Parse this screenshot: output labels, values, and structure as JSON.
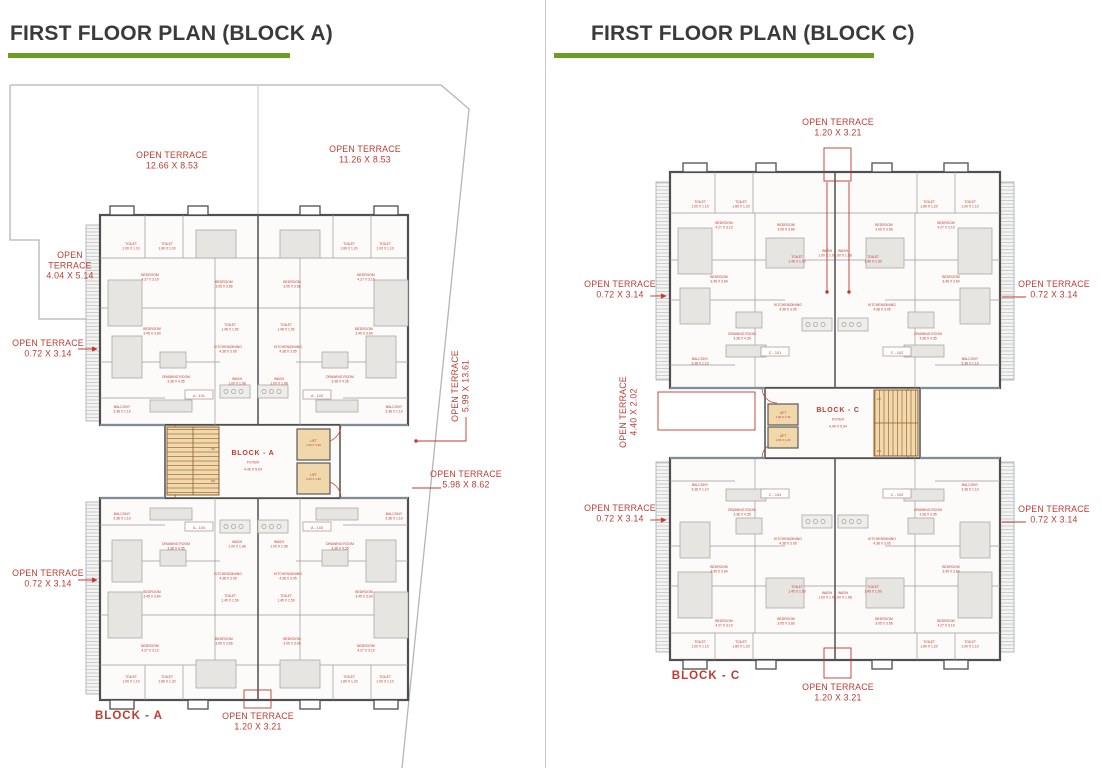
{
  "panels": [
    {
      "title": "FIRST FLOOR PLAN (BLOCK A)"
    },
    {
      "title": "FIRST FLOOR PLAN (BLOCK C)"
    }
  ],
  "colors": {
    "annotation_red": "#bf3b32",
    "heading_green": "#6d9d22",
    "title_gray": "#3a3a3a"
  },
  "left_plan": {
    "core": {
      "x": 253,
      "y": 455,
      "name": "BLOCK - A",
      "sub": "FOYER",
      "dim": "4.40 X 5.04"
    },
    "lift": {
      "label": "LIFT",
      "dim": "1.00 X 1.30",
      "positions": [
        [
          313.5,
          442
        ],
        [
          313.5,
          476
        ]
      ]
    },
    "stair_labels": [
      {
        "t": "UP",
        "x": 213,
        "y": 450
      },
      {
        "t": "DN",
        "x": 213,
        "y": 482
      }
    ],
    "units": [
      {
        "label": "A - 101",
        "x": 199,
        "y": 395
      },
      {
        "label": "A - 102",
        "x": 317,
        "y": 395
      },
      {
        "label": "A - 104",
        "x": 199,
        "y": 527
      },
      {
        "label": "A - 103",
        "x": 317,
        "y": 527
      }
    ],
    "boxes": [
      {
        "x": 244,
        "y": 690,
        "w": 27,
        "h": 18
      }
    ],
    "annotations": [
      {
        "lines": [
          "OPEN TERRACE",
          "12.66 X 8.53"
        ],
        "x": 172,
        "y": 158
      },
      {
        "lines": [
          "OPEN TERRACE",
          "11.26 X 8.53"
        ],
        "x": 365,
        "y": 152
      },
      {
        "lines": [
          "OPEN",
          "TERRACE",
          "4.04 X 5.14"
        ],
        "x": 70,
        "y": 258
      },
      {
        "lines": [
          "OPEN TERRACE",
          "0.72 X 3.14"
        ],
        "x": 48,
        "y": 346,
        "leaders": [
          {
            "pts": [
              [
                78,
                349
              ],
              [
                97,
                349
              ]
            ],
            "arrow": true
          }
        ]
      },
      {
        "lines": [
          "OPEN TERRACE",
          "0.72 X 3.14"
        ],
        "x": 48,
        "y": 576,
        "leaders": [
          {
            "pts": [
              [
                78,
                580
              ],
              [
                97,
                580
              ]
            ],
            "arrow": true
          }
        ]
      },
      {
        "lines": [
          "OPEN TERRACE",
          "5.99 X 13.61"
        ],
        "x": 458,
        "y": 386,
        "rot": -90,
        "leaders": [
          {
            "pts": [
              [
                466,
                417
              ],
              [
                466,
                441
              ],
              [
                416,
                441
              ]
            ],
            "dot": true
          }
        ]
      },
      {
        "lines": [
          "OPEN TERRACE",
          "5.98 X 8.62"
        ],
        "x": 466,
        "y": 477,
        "leaders": [
          {
            "pts": [
              [
                441,
                488
              ],
              [
                412,
                488
              ]
            ]
          }
        ]
      },
      {
        "lines": [
          "OPEN TERRACE",
          "1.20 X 3.21"
        ],
        "x": 258,
        "y": 719
      },
      {
        "lines": [
          "BLOCK  - A"
        ],
        "x": 129,
        "y": 719,
        "size": 11.5,
        "bold": true
      }
    ],
    "rooms": [
      {
        "t": "TOILET",
        "d": "1.00 X 1.10",
        "x": 131,
        "y": 245
      },
      {
        "t": "TOILET",
        "d": "1.89 X 1.20",
        "x": 167,
        "y": 245
      },
      {
        "t": "BEDROOM",
        "d": "4.27 X 3.19",
        "x": 150,
        "y": 276
      },
      {
        "t": "BEDROOM",
        "d": "3.05 X 3.66",
        "x": 224,
        "y": 283
      },
      {
        "t": "BEDROOM",
        "d": "3.45 X 3.64",
        "x": 152,
        "y": 330
      },
      {
        "t": "TOILET",
        "d": "1.45 X 1.50",
        "x": 230,
        "y": 326
      },
      {
        "t": "KITCHEN/DINING",
        "d": "4.38 X 3.05",
        "x": 228,
        "y": 348
      },
      {
        "t": "DRAWING ROOM",
        "d": "3.38 X 4.35",
        "x": 176,
        "y": 378
      },
      {
        "t": "WASH",
        "d": "1.00 X 1.98",
        "x": 237,
        "y": 380
      },
      {
        "t": "BALCONY",
        "d": "3.38 X 1.10",
        "x": 122,
        "y": 408
      },
      {
        "t": "TOILET",
        "d": "1.00 X 1.10",
        "x": 385,
        "y": 245
      },
      {
        "t": "TOILET",
        "d": "1.89 X 1.20",
        "x": 349,
        "y": 245
      },
      {
        "t": "BEDROOM",
        "d": "4.27 X 3.19",
        "x": 366,
        "y": 276
      },
      {
        "t": "BEDROOM",
        "d": "3.05 X 3.66",
        "x": 292,
        "y": 283
      },
      {
        "t": "BEDROOM",
        "d": "3.45 X 3.64",
        "x": 364,
        "y": 330
      },
      {
        "t": "TOILET",
        "d": "1.45 X 1.50",
        "x": 286,
        "y": 326
      },
      {
        "t": "KITCHEN/DINING",
        "d": "4.38 X 3.05",
        "x": 288,
        "y": 348
      },
      {
        "t": "DRAWING ROOM",
        "d": "3.38 X 4.35",
        "x": 340,
        "y": 378
      },
      {
        "t": "WASH",
        "d": "1.00 X 1.98",
        "x": 279,
        "y": 380
      },
      {
        "t": "BALCONY",
        "d": "3.38 X 1.10",
        "x": 394,
        "y": 408
      },
      {
        "t": "TOILET",
        "d": "1.00 X 1.10",
        "x": 131,
        "y": 678
      },
      {
        "t": "TOILET",
        "d": "1.89 X 1.20",
        "x": 167,
        "y": 678
      },
      {
        "t": "BEDROOM",
        "d": "4.27 X 3.19",
        "x": 150,
        "y": 647
      },
      {
        "t": "BEDROOM",
        "d": "3.05 X 3.66",
        "x": 224,
        "y": 640
      },
      {
        "t": "BEDROOM",
        "d": "3.45 X 3.64",
        "x": 152,
        "y": 593
      },
      {
        "t": "TOILET",
        "d": "1.45 X 1.50",
        "x": 230,
        "y": 597
      },
      {
        "t": "KITCHEN/DINING",
        "d": "4.38 X 3.05",
        "x": 228,
        "y": 575
      },
      {
        "t": "DRAWING ROOM",
        "d": "3.38 X 4.35",
        "x": 176,
        "y": 545
      },
      {
        "t": "WASH",
        "d": "1.00 X 1.98",
        "x": 237,
        "y": 543
      },
      {
        "t": "BALCONY",
        "d": "3.38 X 1.10",
        "x": 122,
        "y": 515
      },
      {
        "t": "TOILET",
        "d": "1.00 X 1.10",
        "x": 385,
        "y": 678
      },
      {
        "t": "TOILET",
        "d": "1.89 X 1.20",
        "x": 349,
        "y": 678
      },
      {
        "t": "BEDROOM",
        "d": "4.27 X 3.19",
        "x": 366,
        "y": 647
      },
      {
        "t": "BEDROOM",
        "d": "3.05 X 3.66",
        "x": 292,
        "y": 640
      },
      {
        "t": "BEDROOM",
        "d": "3.45 X 3.64",
        "x": 364,
        "y": 593
      },
      {
        "t": "TOILET",
        "d": "1.45 X 1.50",
        "x": 286,
        "y": 597
      },
      {
        "t": "KITCHEN/DINING",
        "d": "4.38 X 3.05",
        "x": 288,
        "y": 575
      },
      {
        "t": "DRAWING ROOM",
        "d": "3.38 X 4.35",
        "x": 340,
        "y": 545
      },
      {
        "t": "WASH",
        "d": "1.00 X 1.98",
        "x": 279,
        "y": 543
      },
      {
        "t": "BALCONY",
        "d": "3.38 X 1.10",
        "x": 394,
        "y": 515
      }
    ]
  },
  "right_plan": {
    "core": {
      "x": 838,
      "y": 412,
      "name": "BLOCK - C",
      "sub": "FOYER",
      "dim": "4.40 X 5.04"
    },
    "lift": {
      "label": "LIFT",
      "dim": "1.00 X 1.30",
      "positions": [
        [
          783,
          414
        ],
        [
          783,
          437
        ]
      ]
    },
    "stair_labels": [
      {
        "t": "UP",
        "x": 879,
        "y": 400
      },
      {
        "t": "DN",
        "x": 879,
        "y": 452
      }
    ],
    "units": [
      {
        "label": "C - 101",
        "x": 775,
        "y": 352
      },
      {
        "label": "C - 102",
        "x": 897,
        "y": 352
      },
      {
        "label": "C - 104",
        "x": 775,
        "y": 494
      },
      {
        "label": "C - 103",
        "x": 897,
        "y": 494
      }
    ],
    "boxes": [
      {
        "x": 824,
        "y": 148,
        "w": 27,
        "h": 33
      },
      {
        "x": 824,
        "y": 648,
        "w": 27,
        "h": 30
      },
      {
        "x": 658,
        "y": 392,
        "w": 97,
        "h": 38
      }
    ],
    "annotations": [
      {
        "lines": [
          "OPEN TERRACE",
          "1.20 X 3.21"
        ],
        "x": 838,
        "y": 125,
        "leaders": [
          {
            "pts": [
              [
                827,
                182
              ],
              [
                827,
                292
              ]
            ],
            "dot": true
          },
          {
            "pts": [
              [
                849,
                182
              ],
              [
                849,
                292
              ]
            ],
            "dot": true
          }
        ]
      },
      {
        "lines": [
          "OPEN TERRACE",
          "0.72 X 3.14"
        ],
        "x": 620,
        "y": 287,
        "leaders": [
          {
            "pts": [
              [
                650,
                296
              ],
              [
                666,
                296
              ]
            ],
            "arrow": true
          }
        ]
      },
      {
        "lines": [
          "OPEN TERRACE",
          "4.40 X 2.02"
        ],
        "x": 626,
        "y": 412,
        "rot": -90
      },
      {
        "lines": [
          "OPEN TERRACE",
          "0.72 X 3.14"
        ],
        "x": 620,
        "y": 511,
        "leaders": [
          {
            "pts": [
              [
                650,
                520
              ],
              [
                666,
                520
              ]
            ],
            "arrow": true
          }
        ]
      },
      {
        "lines": [
          "OPEN TERRACE",
          "0.72 X 3.14"
        ],
        "x": 1054,
        "y": 287,
        "leaders": [
          {
            "pts": [
              [
                1026,
                297
              ],
              [
                1002,
                297
              ]
            ]
          }
        ]
      },
      {
        "lines": [
          "OPEN TERRACE",
          "0.72 X 3.14"
        ],
        "x": 1054,
        "y": 512,
        "leaders": [
          {
            "pts": [
              [
                1026,
                522
              ],
              [
                1002,
                522
              ]
            ]
          }
        ]
      },
      {
        "lines": [
          "OPEN TERRACE",
          "1.20 X 3.21"
        ],
        "x": 838,
        "y": 690
      },
      {
        "lines": [
          "BLOCK  - C"
        ],
        "x": 706,
        "y": 679,
        "size": 11.5,
        "bold": true
      }
    ],
    "rooms": [
      {
        "t": "TOILET",
        "d": "1.00 X 1.10",
        "x": 700,
        "y": 203
      },
      {
        "t": "TOILET",
        "d": "1.89 X 1.20",
        "x": 741,
        "y": 203
      },
      {
        "t": "BEDROOM",
        "d": "4.27 X 3.19",
        "x": 724,
        "y": 224
      },
      {
        "t": "BEDROOM",
        "d": "3.05 X 3.66",
        "x": 786,
        "y": 226
      },
      {
        "t": "BEDROOM",
        "d": "3.45 X 3.64",
        "x": 719,
        "y": 278
      },
      {
        "t": "TOILET",
        "d": "1.45 X 1.50",
        "x": 797,
        "y": 258
      },
      {
        "t": "WASH",
        "d": "1.00 X 1.98",
        "x": 827,
        "y": 252
      },
      {
        "t": "KITCHEN/DINING",
        "d": "4.38 X 3.05",
        "x": 788,
        "y": 306
      },
      {
        "t": "DRAWING ROOM",
        "d": "3.38 X 4.35",
        "x": 742,
        "y": 335
      },
      {
        "t": "BALCONY",
        "d": "3.38 X 1.10",
        "x": 700,
        "y": 360
      },
      {
        "t": "TOILET",
        "d": "1.00 X 1.10",
        "x": 970,
        "y": 203
      },
      {
        "t": "TOILET",
        "d": "1.89 X 1.20",
        "x": 929,
        "y": 203
      },
      {
        "t": "BEDROOM",
        "d": "4.27 X 3.19",
        "x": 946,
        "y": 224
      },
      {
        "t": "BEDROOM",
        "d": "3.05 X 3.66",
        "x": 884,
        "y": 226
      },
      {
        "t": "BEDROOM",
        "d": "3.45 X 3.64",
        "x": 951,
        "y": 278
      },
      {
        "t": "TOILET",
        "d": "1.45 X 1.50",
        "x": 873,
        "y": 258
      },
      {
        "t": "WASH",
        "d": "1.00 X 1.98",
        "x": 843,
        "y": 252
      },
      {
        "t": "KITCHEN/DINING",
        "d": "4.38 X 3.05",
        "x": 882,
        "y": 306
      },
      {
        "t": "DRAWING ROOM",
        "d": "3.38 X 4.35",
        "x": 928,
        "y": 335
      },
      {
        "t": "BALCONY",
        "d": "3.38 X 1.10",
        "x": 970,
        "y": 360
      },
      {
        "t": "TOILET",
        "d": "1.00 X 1.10",
        "x": 700,
        "y": 643
      },
      {
        "t": "TOILET",
        "d": "1.89 X 1.20",
        "x": 741,
        "y": 643
      },
      {
        "t": "BEDROOM",
        "d": "4.27 X 3.19",
        "x": 724,
        "y": 622
      },
      {
        "t": "BEDROOM",
        "d": "3.05 X 3.66",
        "x": 786,
        "y": 620
      },
      {
        "t": "BEDROOM",
        "d": "3.45 X 3.64",
        "x": 719,
        "y": 568
      },
      {
        "t": "TOILET",
        "d": "1.45 X 1.50",
        "x": 797,
        "y": 588
      },
      {
        "t": "WASH",
        "d": "1.00 X 1.98",
        "x": 827,
        "y": 594
      },
      {
        "t": "KITCHEN/DINING",
        "d": "4.38 X 3.05",
        "x": 788,
        "y": 540
      },
      {
        "t": "DRAWING ROOM",
        "d": "3.38 X 4.35",
        "x": 742,
        "y": 511
      },
      {
        "t": "BALCONY",
        "d": "3.38 X 1.10",
        "x": 700,
        "y": 486
      },
      {
        "t": "TOILET",
        "d": "1.00 X 1.10",
        "x": 970,
        "y": 643
      },
      {
        "t": "TOILET",
        "d": "1.89 X 1.20",
        "x": 929,
        "y": 643
      },
      {
        "t": "BEDROOM",
        "d": "4.27 X 3.19",
        "x": 946,
        "y": 622
      },
      {
        "t": "BEDROOM",
        "d": "3.05 X 3.66",
        "x": 884,
        "y": 620
      },
      {
        "t": "BEDROOM",
        "d": "3.45 X 3.64",
        "x": 951,
        "y": 568
      },
      {
        "t": "TOILET",
        "d": "1.45 X 1.50",
        "x": 873,
        "y": 588
      },
      {
        "t": "WASH",
        "d": "1.00 X 1.98",
        "x": 843,
        "y": 594
      },
      {
        "t": "KITCHEN/DINING",
        "d": "4.38 X 3.05",
        "x": 882,
        "y": 540
      },
      {
        "t": "DRAWING ROOM",
        "d": "3.38 X 4.35",
        "x": 928,
        "y": 511
      },
      {
        "t": "BALCONY",
        "d": "3.38 X 1.10",
        "x": 970,
        "y": 486
      }
    ]
  }
}
